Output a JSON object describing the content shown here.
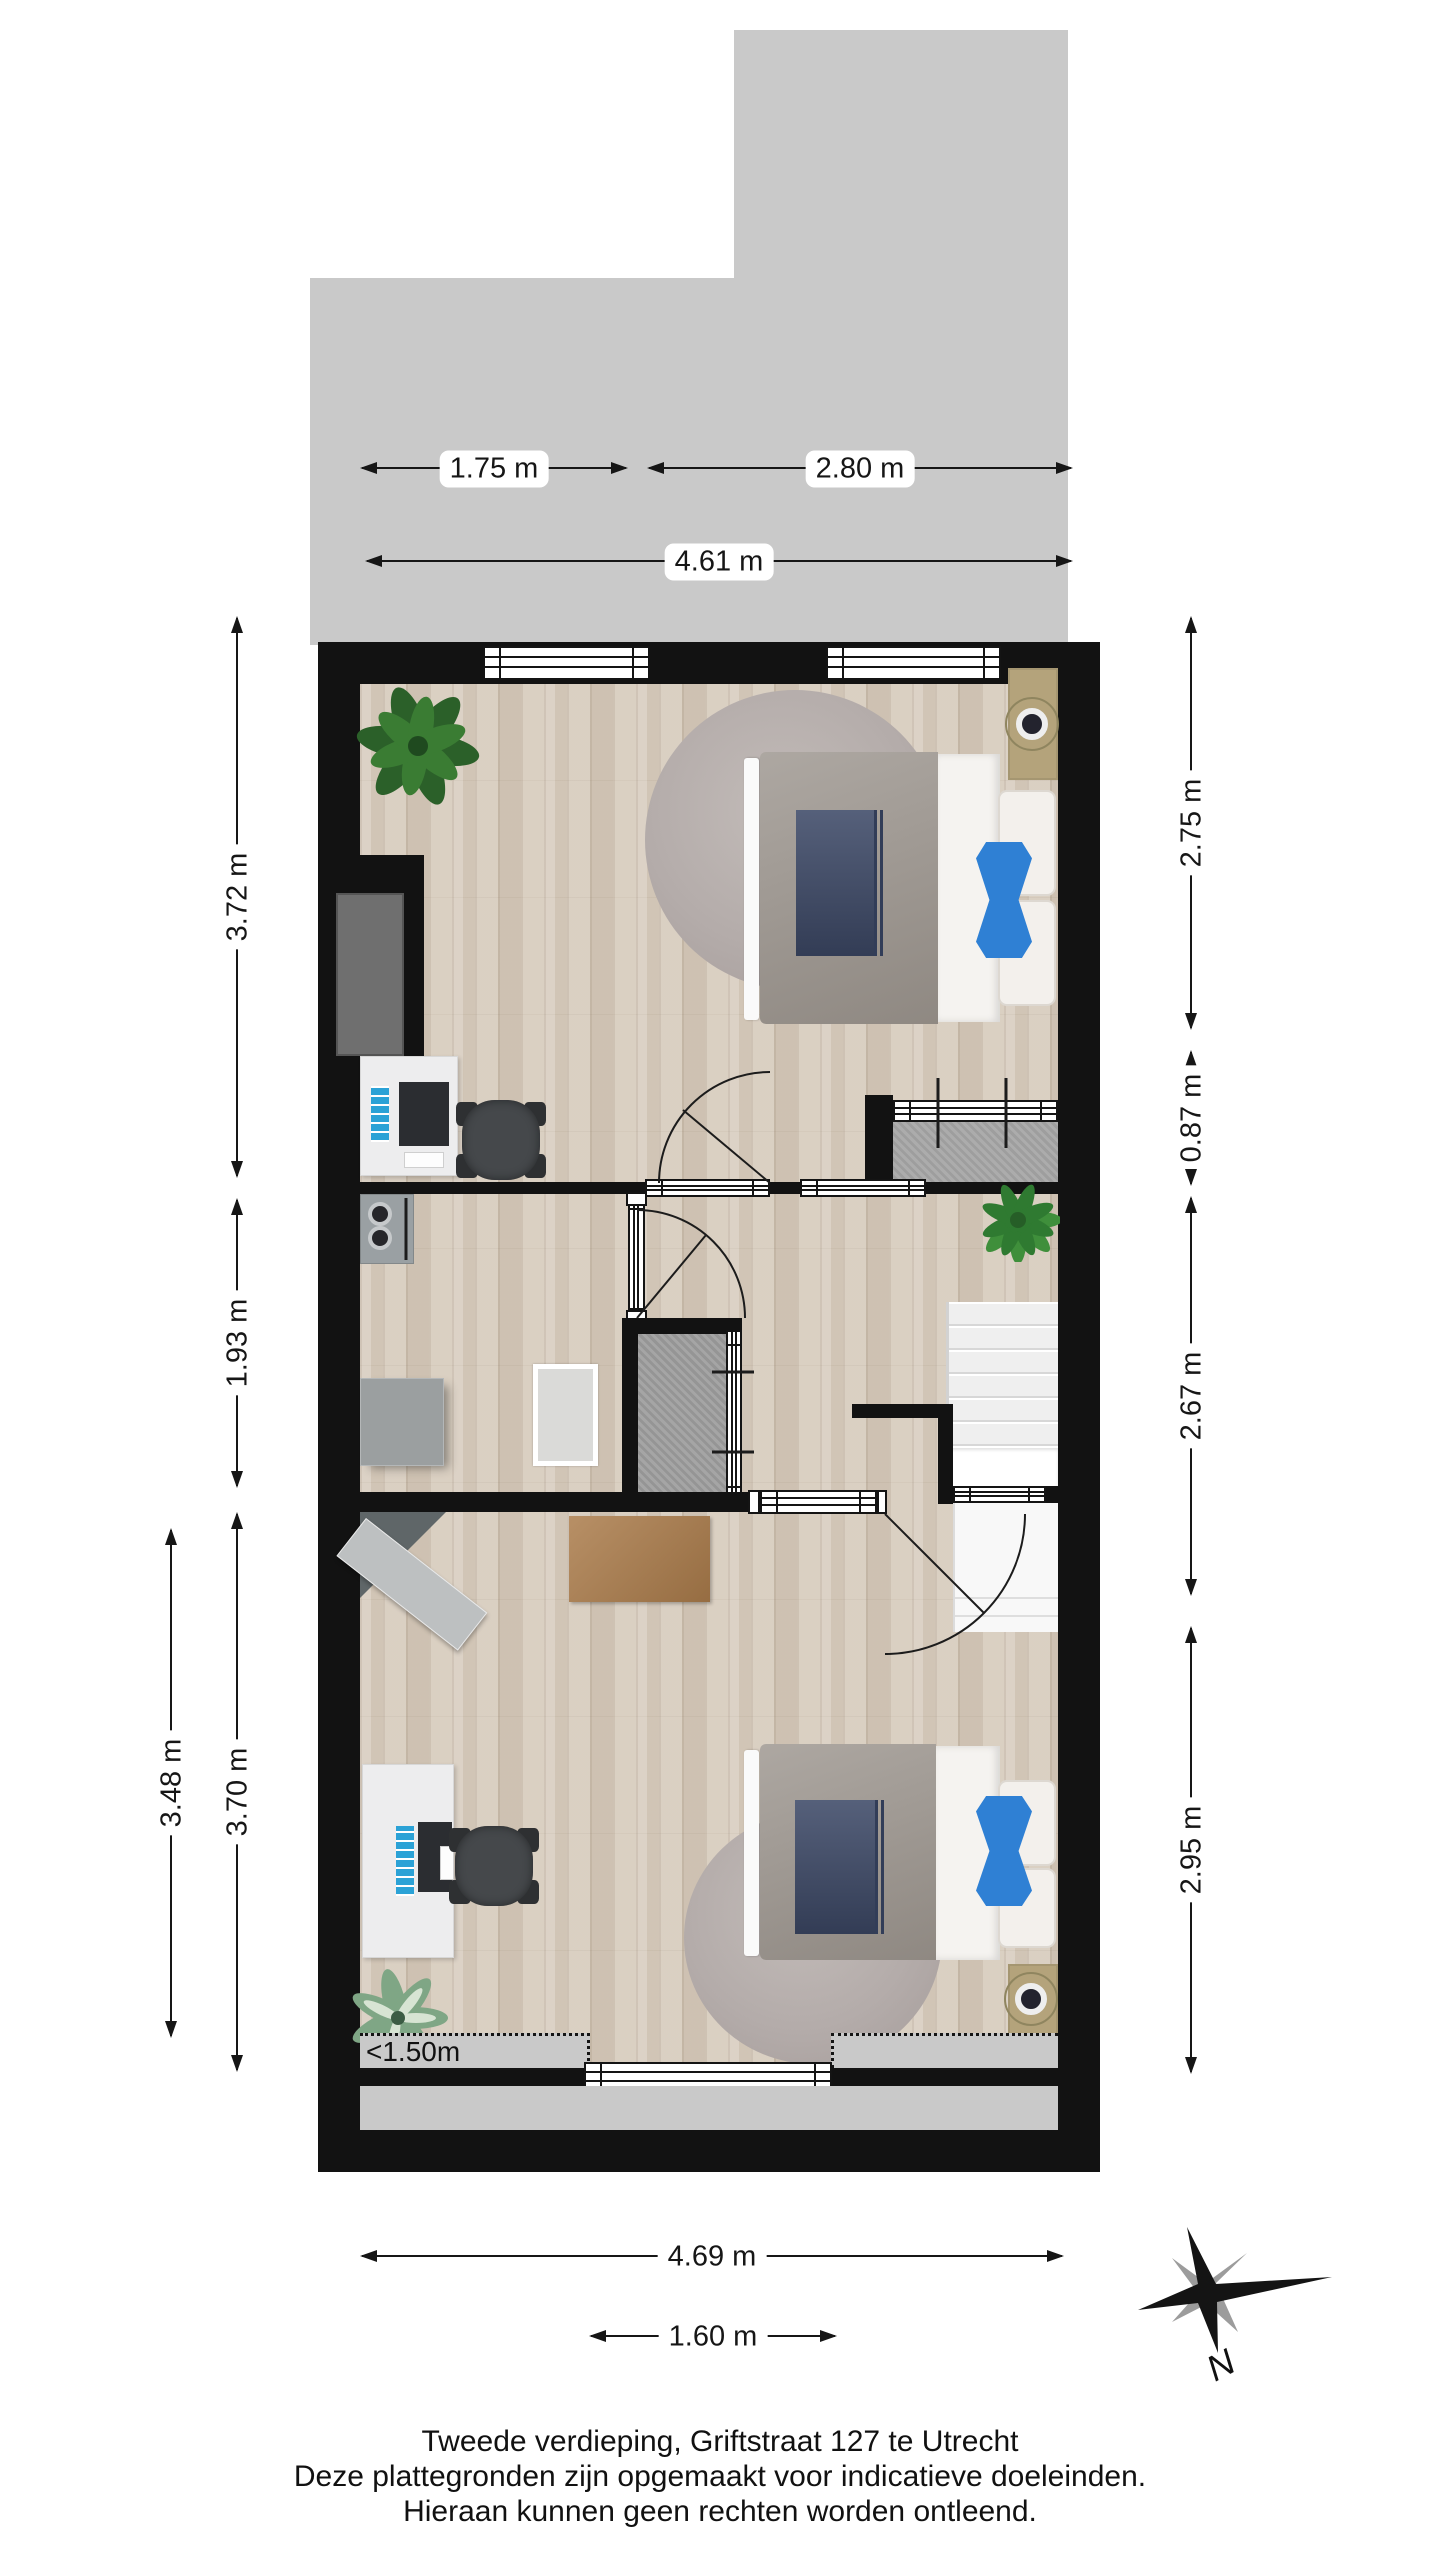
{
  "floorplan": {
    "dimensions": {
      "t1": "1.75 m",
      "t2": "2.80 m",
      "t3": "4.61 m",
      "b1": "4.69 m",
      "b2": "1.60 m",
      "l1": "3.72 m",
      "l2": "1.93 m",
      "l3": "3.70 m",
      "l4": "3.48 m",
      "r1": "2.75 m",
      "r2": "0.87 m",
      "r3": "2.67 m",
      "r4": "2.95 m"
    },
    "annotation_low_ceiling": "<1.50m",
    "compass": {
      "north_label": "N"
    },
    "colors": {
      "wall": "#121212",
      "terrace_gray": "#c9c9c9",
      "wood_floor": "#d7ccbe",
      "carpet_gray": "#a7a7a7",
      "stairs_white": "#f4f4f4",
      "pillow_blue": "#2f80d4",
      "blanket_navy": "#3e4a68",
      "duvet_gray": "#9b948d",
      "nightstand_tan": "#b4a37b"
    }
  },
  "footer": {
    "line1": "Tweede verdieping, Griftstraat 127 te Utrecht",
    "line2": "Deze plattegronden zijn opgemaakt voor indicatieve doeleinden.",
    "line3": "Hieraan kunnen geen rechten worden ontleend."
  }
}
